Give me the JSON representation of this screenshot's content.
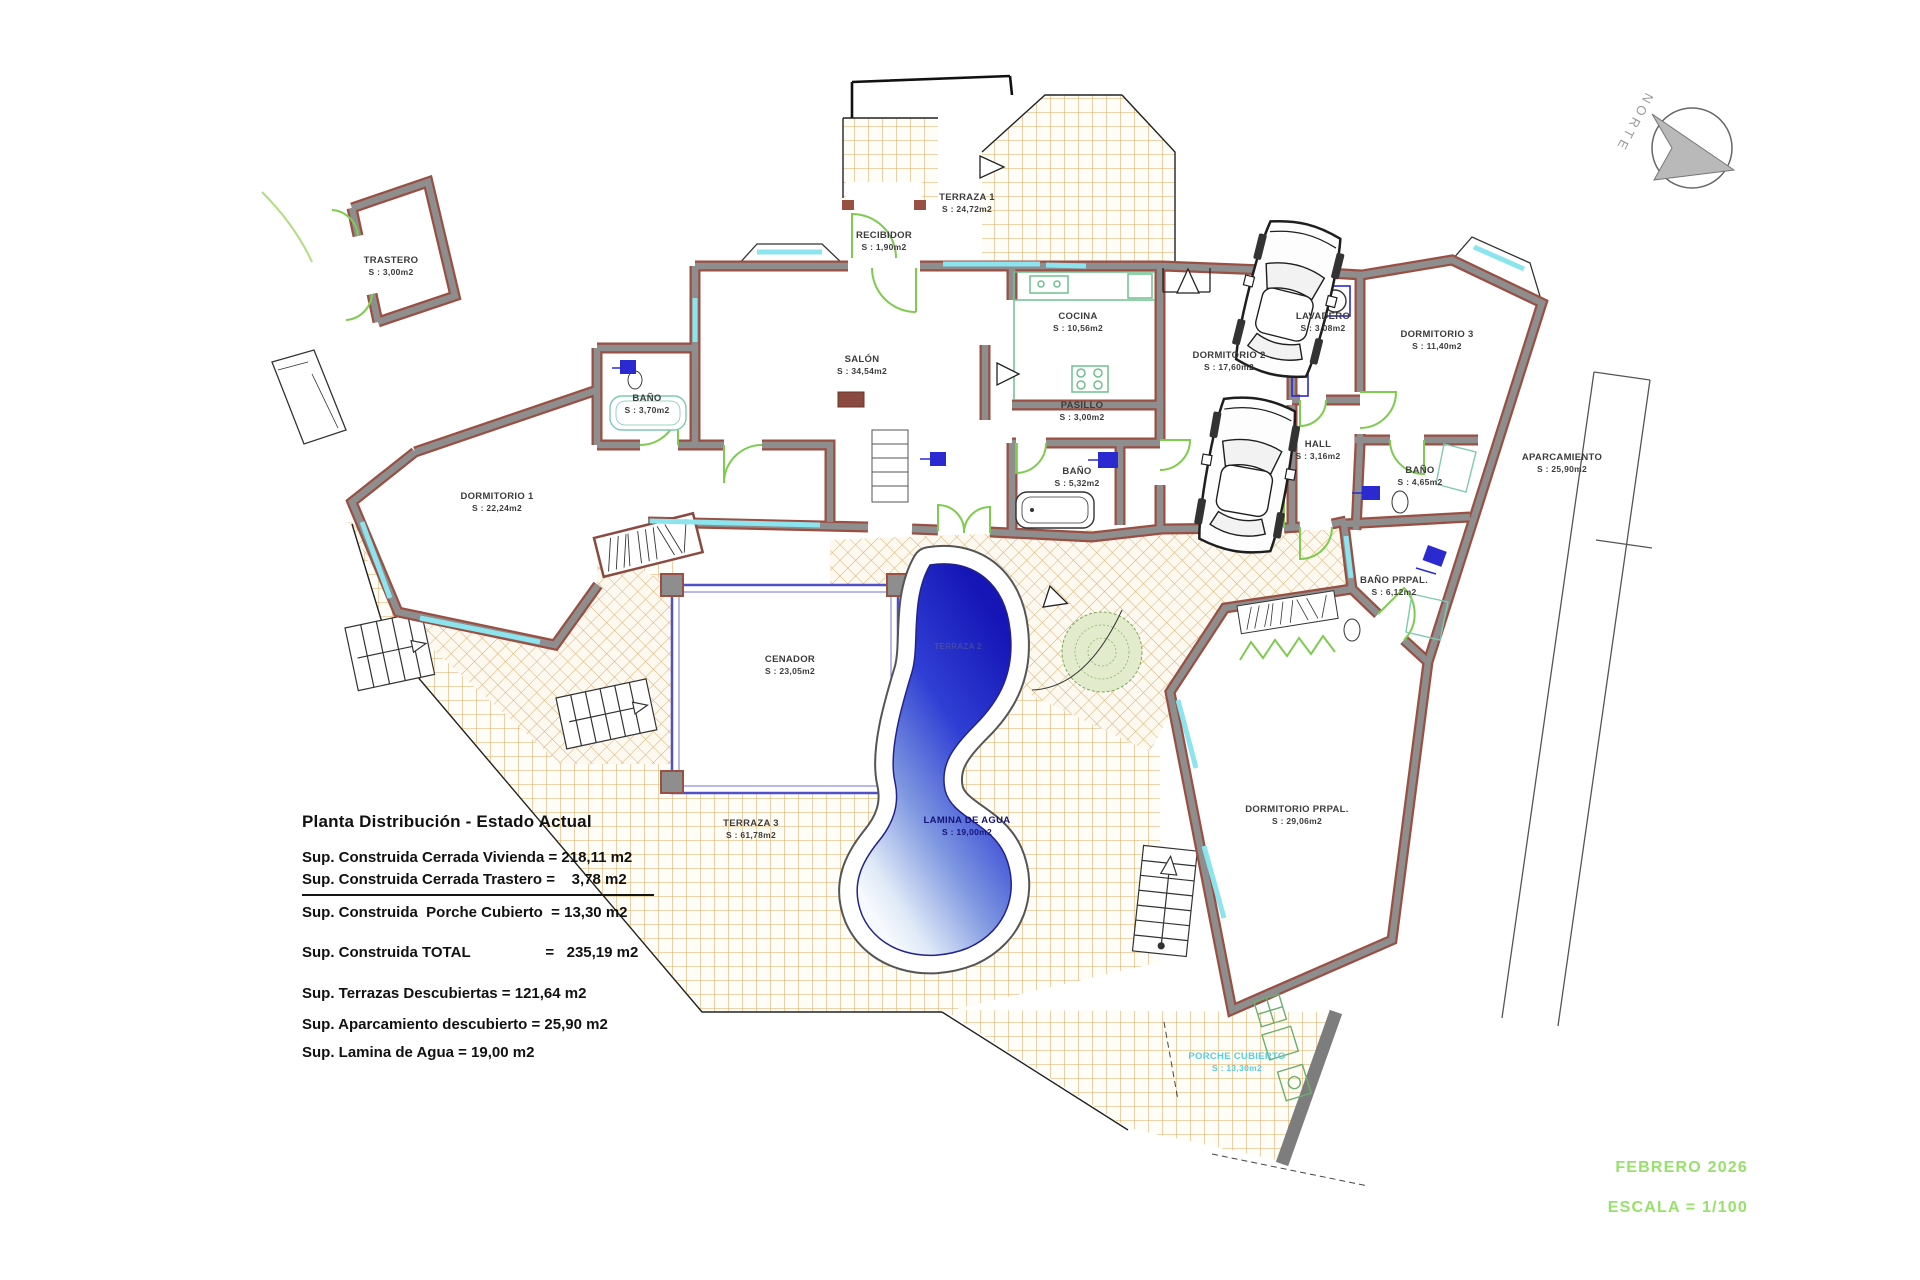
{
  "document": {
    "title": "Planta Distribución - Estado Actual"
  },
  "summary": {
    "lines": [
      "Sup. Construida Cerrada Vivienda = 218,11 m2",
      "Sup. Construida Cerrada Trastero =    3,78 m2",
      "Sup. Construida  Porche Cubierto  = 13,30 m2",
      "Sup. Construida TOTAL                  =   235,19 m2",
      "Sup. Terrazas Descubiertas = 121,64 m2",
      "Sup. Aparcamiento descubierto = 25,90 m2",
      "Sup. Lamina de Agua = 19,00 m2"
    ]
  },
  "footer": {
    "date_label": "FEBRERO 2026",
    "scale_label": "ESCALA = 1/100"
  },
  "compass": {
    "label": "NORTE"
  },
  "rooms": [
    {
      "id": "trastero",
      "name": "TRASTERO",
      "area": "S : 3,00m2",
      "x": 391,
      "y": 266
    },
    {
      "id": "terraza-1",
      "name": "TERRAZA 1",
      "area": "S : 24,72m2",
      "x": 967,
      "y": 203
    },
    {
      "id": "recibidor",
      "name": "RECIBIDOR",
      "area": "S : 1,90m2",
      "x": 884,
      "y": 241
    },
    {
      "id": "salon",
      "name": "SALÓN",
      "area": "S : 34,54m2",
      "x": 862,
      "y": 365
    },
    {
      "id": "cocina",
      "name": "COCINA",
      "area": "S : 10,56m2",
      "x": 1078,
      "y": 322
    },
    {
      "id": "dormitorio-2",
      "name": "DORMITORIO 2",
      "area": "S : 17,60m2",
      "x": 1229,
      "y": 361
    },
    {
      "id": "lavadero",
      "name": "LAVADERO",
      "area": "S : 3,08m2",
      "x": 1323,
      "y": 322
    },
    {
      "id": "dormitorio-3",
      "name": "DORMITORIO 3",
      "area": "S : 11,40m2",
      "x": 1437,
      "y": 340
    },
    {
      "id": "bano-1",
      "name": "BAÑO",
      "area": "S : 3,70m2",
      "x": 647,
      "y": 404
    },
    {
      "id": "pasillo",
      "name": "PASILLO",
      "area": "S : 3,00m2",
      "x": 1082,
      "y": 411
    },
    {
      "id": "bano-2",
      "name": "BAÑO",
      "area": "S : 5,32m2",
      "x": 1077,
      "y": 477
    },
    {
      "id": "hall",
      "name": "HALL",
      "area": "S : 3,16m2",
      "x": 1318,
      "y": 450
    },
    {
      "id": "bano-3",
      "name": "BAÑO",
      "area": "S : 4,65m2",
      "x": 1420,
      "y": 476
    },
    {
      "id": "dormitorio-1",
      "name": "DORMITORIO 1",
      "area": "S : 22,24m2",
      "x": 497,
      "y": 502
    },
    {
      "id": "aparcamiento",
      "name": "APARCAMIENTO",
      "area": "S : 25,90m2",
      "x": 1562,
      "y": 463
    },
    {
      "id": "bano-prpal",
      "name": "BAÑO PRPAL.",
      "area": "S : 6,12m2",
      "x": 1394,
      "y": 586
    },
    {
      "id": "cenador",
      "name": "CENADOR",
      "area": "S : 23,05m2",
      "x": 790,
      "y": 665
    },
    {
      "id": "dormitorio-prpal",
      "name": "DORMITORIO PRPAL.",
      "area": "S : 29,06m2",
      "x": 1297,
      "y": 815
    },
    {
      "id": "terraza-3",
      "name": "TERRAZA 3",
      "area": "S : 61,78m2",
      "x": 751,
      "y": 829
    },
    {
      "id": "lamina-de-agua",
      "name": "LAMINA DE AGUA",
      "area": "S : 19,00m2",
      "x": 967,
      "y": 826,
      "color": "#141478"
    },
    {
      "id": "porche-cubierto",
      "name": "PORCHE CUBIERTO",
      "area": "S : 13,30m2",
      "x": 1237,
      "y": 1062,
      "color": "#56cfe0"
    },
    {
      "id": "terraza-2",
      "name": "TERRAZA 2",
      "area": "",
      "x": 958,
      "y": 647,
      "faint": true
    }
  ],
  "palette": {
    "wall_edge": "#9a4f43",
    "wall_fill": "#8e8e8e",
    "window_cyan": "#8ce4ee",
    "door_green": "#7dcb4f",
    "tile_tan": "#dcaa62",
    "pool_dark_blue": "#1616b6",
    "pool_light_blue": "#dfe9f7",
    "footer_green": "#97e06c"
  }
}
